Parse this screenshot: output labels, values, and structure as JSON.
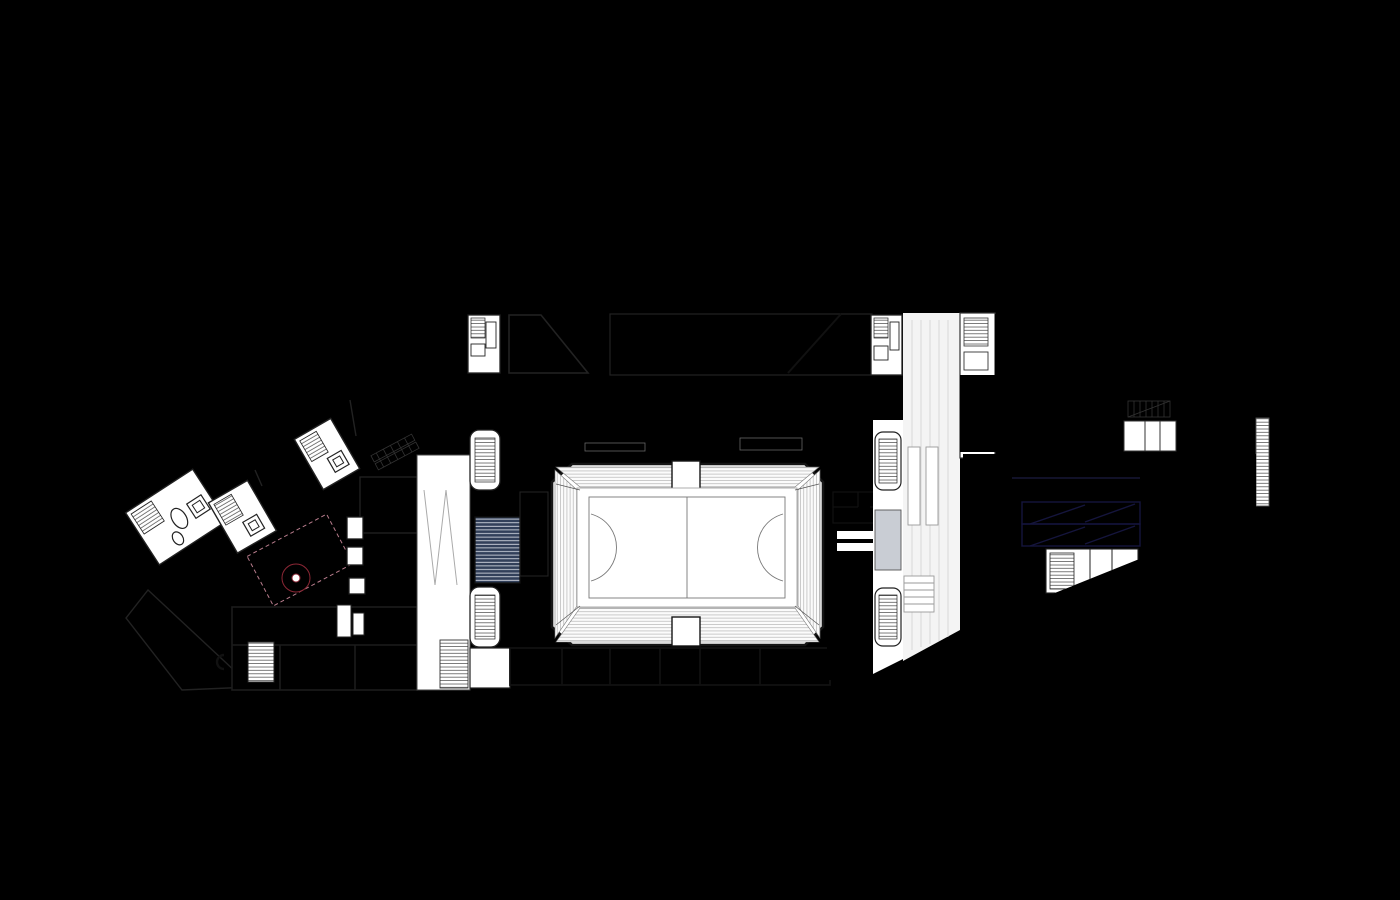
{
  "title": "architectural-site-plan-ground-floor",
  "palette": {
    "background": "#dcdcdc",
    "road_line": "#c3c3c3",
    "road_line_light": "#cccccc",
    "building_gray": "#9b9b9b",
    "white_building": "#fcfcfc",
    "outline_dark": "#3a3a3a",
    "plan_outline": "#1f1f1f",
    "boundary_red": "#cf372b",
    "tree_fill": "#cdca86",
    "tree_stroke": "#b2ae6b",
    "pink_bright": "#f7a6d4",
    "pink_plaza": "#f2abc1",
    "raspberry": "#ec5e80",
    "red_room": "#cd4a52",
    "red_terrace": "#cf4a42",
    "maroon": "#a93044",
    "maroon_dark": "#8f2436",
    "slate_triangle": "#9fb4ba",
    "foyer_slate": "#96a1b3",
    "room_slate": "#5e7294",
    "room_slate_light": "#b9c0cb",
    "navy": "#32405a",
    "blue_parking": "#7678e6",
    "blue_line": "#22224f",
    "court_line": "#888888",
    "white": "#ffffff"
  },
  "regions": [
    {
      "name": "site-boundary",
      "color": "#cf372b"
    },
    {
      "name": "existing-buildings",
      "color": "#9b9b9b"
    },
    {
      "name": "planned-white-buildings",
      "color": "#fcfcfc"
    },
    {
      "name": "tree-planting",
      "color": "#cdca86"
    },
    {
      "name": "pink-circulation-ramp",
      "color": "#f7a6d4"
    },
    {
      "name": "public-plaza",
      "color": "#f2abc1"
    },
    {
      "name": "raspberry-program-rooms",
      "color": "#ec5e80"
    },
    {
      "name": "red-hall-with-furniture",
      "color": "#cd4a52"
    },
    {
      "name": "outdoor-terrace",
      "color": "#cf4a42"
    },
    {
      "name": "maroon-back-rooms",
      "color": "#a93044"
    },
    {
      "name": "sports-hall-foyer",
      "color": "#96a1b3"
    },
    {
      "name": "sports-court",
      "color": "#ffffff"
    },
    {
      "name": "service-rooms-navy",
      "color": "#32405a"
    },
    {
      "name": "parking-garage",
      "color": "#7678e6"
    }
  ],
  "trees": {
    "grid": [
      {
        "y": 146,
        "r": 16,
        "xs": [
          612,
          655,
          697,
          739,
          781,
          823,
          866,
          908
        ]
      },
      {
        "y": 179,
        "r": 16,
        "xs": [
          591,
          634,
          676,
          718,
          759,
          801,
          843,
          884
        ]
      },
      {
        "y": 212,
        "r": 16,
        "xs": [
          573,
          614,
          656,
          698,
          739,
          781,
          823,
          863
        ]
      }
    ],
    "singles": [
      [
        1268,
        104,
        13
      ],
      [
        1306,
        95,
        13
      ],
      [
        1344,
        87,
        13
      ],
      [
        1383,
        79,
        13
      ],
      [
        1322,
        133,
        15
      ],
      [
        1355,
        137,
        13
      ],
      [
        1340,
        152,
        12
      ],
      [
        1308,
        148,
        11
      ],
      [
        1362,
        470,
        15
      ],
      [
        1390,
        483,
        12
      ],
      [
        1371,
        500,
        12
      ],
      [
        1395,
        512,
        10
      ],
      [
        1322,
        578,
        11
      ],
      [
        1358,
        562,
        13
      ],
      [
        1392,
        553,
        13
      ],
      [
        86,
        540,
        16
      ],
      [
        58,
        585,
        14
      ],
      [
        103,
        615,
        13
      ],
      [
        14,
        568,
        14
      ],
      [
        142,
        658,
        24
      ],
      [
        209,
        684,
        24
      ]
    ]
  },
  "columns": [
    {
      "y": 311,
      "xs": [
        573,
        618,
        663,
        708,
        753,
        798,
        843,
        888
      ]
    },
    {
      "y": 419,
      "xs": [
        478,
        523,
        568,
        613,
        658,
        703,
        748,
        793,
        838,
        883
      ]
    },
    {
      "y": 417,
      "xs": [
        1000,
        1045,
        1090,
        1135,
        1180
      ]
    }
  ],
  "bike_racks": [
    {
      "y": 296,
      "xs": [
        698,
        710,
        722,
        734,
        746
      ]
    },
    {
      "y": 296,
      "xs": [
        774,
        786,
        798,
        810,
        822
      ]
    },
    {
      "y": 384,
      "xs": [
        630,
        643,
        656,
        669,
        682,
        695,
        708,
        721
      ]
    }
  ],
  "red_room_furniture": [
    [
      650,
      329
    ],
    [
      671,
      327
    ],
    [
      692,
      330
    ],
    [
      713,
      327
    ],
    [
      734,
      330
    ],
    [
      756,
      328
    ],
    [
      777,
      330
    ],
    [
      640,
      352
    ],
    [
      659,
      359
    ],
    [
      677,
      354
    ],
    [
      695,
      361
    ],
    [
      713,
      355
    ],
    [
      662,
      371
    ],
    [
      681,
      374
    ],
    [
      646,
      367
    ]
  ],
  "terrace_tables": [
    [
      170,
      621
    ],
    [
      184,
      632
    ],
    [
      197,
      643
    ],
    [
      175,
      649
    ],
    [
      207,
      659
    ],
    [
      190,
      663
    ],
    [
      219,
      671
    ],
    [
      231,
      682
    ],
    [
      205,
      677
    ]
  ],
  "reading_tables": {
    "rows_y": [
      608,
      621,
      634
    ],
    "xs": [
      278,
      292,
      306,
      320,
      334
    ]
  },
  "parking": {
    "stall_ticks_x": [
      1018,
      1031,
      1044,
      1057,
      1070,
      1083,
      1096,
      1109,
      1122,
      1135
    ],
    "stall_tick_y1": 478,
    "stall_tick_y2": 498,
    "left_tick_ys": [
      467,
      478,
      489,
      500,
      511,
      522,
      533,
      544
    ],
    "right_line_ys": [
      478,
      487,
      496
    ]
  }
}
